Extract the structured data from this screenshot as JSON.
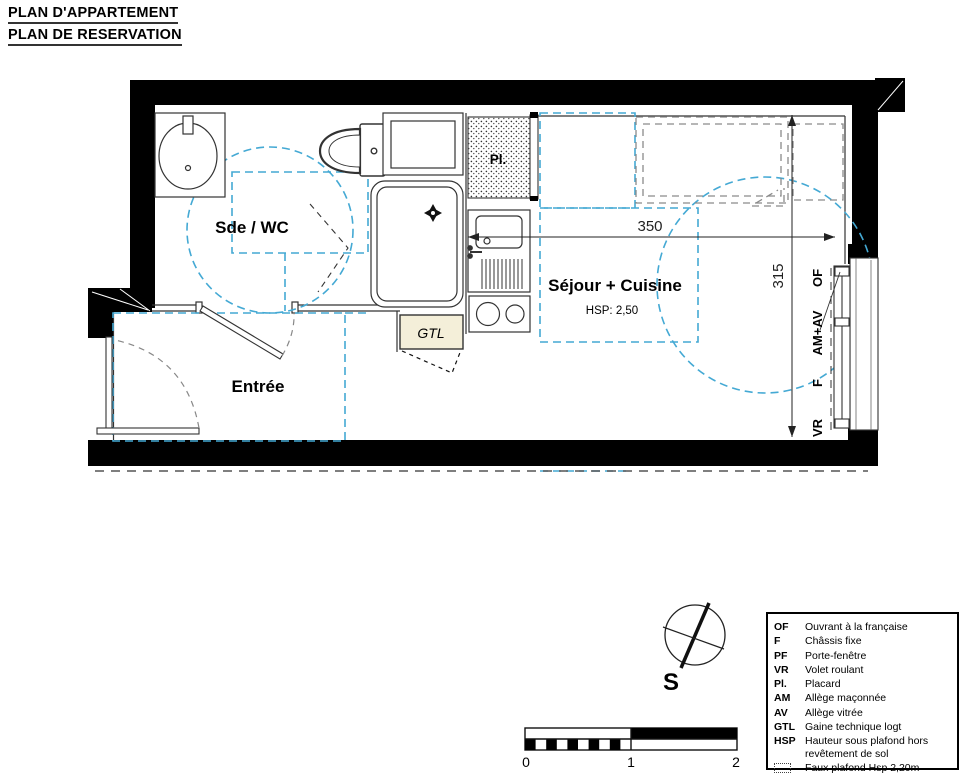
{
  "header": {
    "title_line1": "PLAN D'APPARTEMENT",
    "title_line2": "PLAN DE RESERVATION"
  },
  "plan": {
    "rooms": {
      "bathroom": "Sde / WC",
      "entry": "Entrée",
      "living": "Séjour + Cuisine",
      "living_height": "HSP: 2,50",
      "closet": "Pl.",
      "duct": "GTL"
    },
    "dimensions": {
      "width": "350",
      "height": "315"
    },
    "window_labels": {
      "of": "OF",
      "am_av": "AM+AV",
      "f": "F",
      "vr": "VR"
    }
  },
  "compass": {
    "label": "S"
  },
  "scale_bar": {
    "tick0": "0",
    "tick1": "1",
    "tick2": "2"
  },
  "legend": {
    "items": [
      {
        "abbr": "OF",
        "label": "Ouvrant à la française"
      },
      {
        "abbr": "F",
        "label": "Châssis fixe"
      },
      {
        "abbr": "PF",
        "label": "Porte-fenêtre"
      },
      {
        "abbr": "VR",
        "label": "Volet roulant"
      },
      {
        "abbr": "Pl.",
        "label": "Placard"
      },
      {
        "abbr": "AM",
        "label": "Allège maçonnée"
      },
      {
        "abbr": "AV",
        "label": "Allège vitrée"
      },
      {
        "abbr": "GTL",
        "label": "Gaine technique logt"
      },
      {
        "abbr": "HSP",
        "label": "Hauteur sous plafond hors revêtement de sol"
      },
      {
        "abbr": "",
        "label": "Faux plafond Hsp 2,20m"
      }
    ]
  },
  "colors": {
    "accent_blue": "#44A9D4",
    "wall_black": "#000000",
    "gtl_fill": "#F4EFD9",
    "furniture_gray": "#8A8A8A"
  }
}
